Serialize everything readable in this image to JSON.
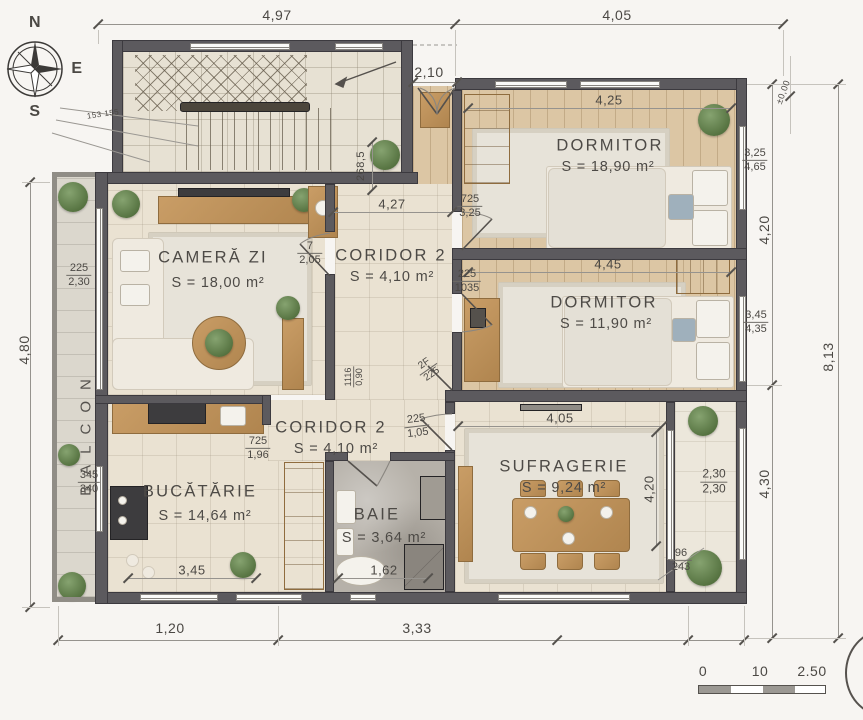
{
  "compass": {
    "n": "N",
    "e": "E",
    "s": "S"
  },
  "rooms": {
    "camera_zi": {
      "name": "CAMERĂ ZI",
      "area": "S = 18,00 m²"
    },
    "coridor_sus": {
      "name": "CORIDOR 2",
      "area": "S = 4,10 m²"
    },
    "dormitor_mare": {
      "name": "DORMITOR",
      "area": "S = 18,90 m²"
    },
    "dormitor_mic": {
      "name": "DORMITOR",
      "area": "S = 11,90 m²"
    },
    "coridor_jos": {
      "name": "CORIDOR 2",
      "area": "S = 4,10 m²"
    },
    "bucatarie": {
      "name": "BUCĂTĂRIE",
      "area": "S = 14,64 m²"
    },
    "baie": {
      "name": "BAIE",
      "area": "S = 3,64 m²"
    },
    "sufragerie": {
      "name": "SUFRAGERIE",
      "area": "S = 9,24 m²"
    },
    "balcon": {
      "name": "BALCON"
    }
  },
  "dims": {
    "top_left": "4,97",
    "top_right": "4,05",
    "entry": "2,10",
    "left_height": "4,80",
    "right_upper": "4,20",
    "right_lower": "4,30",
    "right_total": "8,13",
    "level": "±0,00",
    "bottom_left": "1,20",
    "bottom_mid": "3,33",
    "dorm1_width": "4,25",
    "dorm2_width": "4,45",
    "hall_width": "4,27",
    "suf_width": "4,05",
    "suf_height": "4,20",
    "kitchen_width": "3,45",
    "baie_width": "1,62",
    "stair_depth": "268,5",
    "stair_note": "153 155"
  },
  "fracs": {
    "balcon_win": {
      "top": "225",
      "bot": "2,30"
    },
    "cz_door": {
      "top": "7",
      "bot": "2,05"
    },
    "dorm1_door": {
      "top": "725",
      "bot": "3,25"
    },
    "dorm2_door": {
      "top": "225",
      "bot": "1035"
    },
    "cz_pass": {
      "top": "1116",
      "bot": "0,90"
    },
    "closet_door": {
      "top": "2F",
      "bot": "225"
    },
    "suf_door": {
      "top": "225",
      "bot": "1,05"
    },
    "kitchen_door": {
      "top": "725",
      "bot": "1,96"
    },
    "entry_side": {
      "top": "345",
      "bot": "340"
    },
    "dorm1_win": {
      "top": "3,25",
      "bot": "4,65"
    },
    "dorm2_win": {
      "top": "3,45",
      "bot": "4,35"
    },
    "suf_win": {
      "top": "2,30",
      "bot": "2,30"
    },
    "suf_niche_win": {
      "top": "96",
      "bot": "243"
    }
  },
  "scale_bar": {
    "start": "0",
    "mid": "10",
    "end": "2.50"
  }
}
